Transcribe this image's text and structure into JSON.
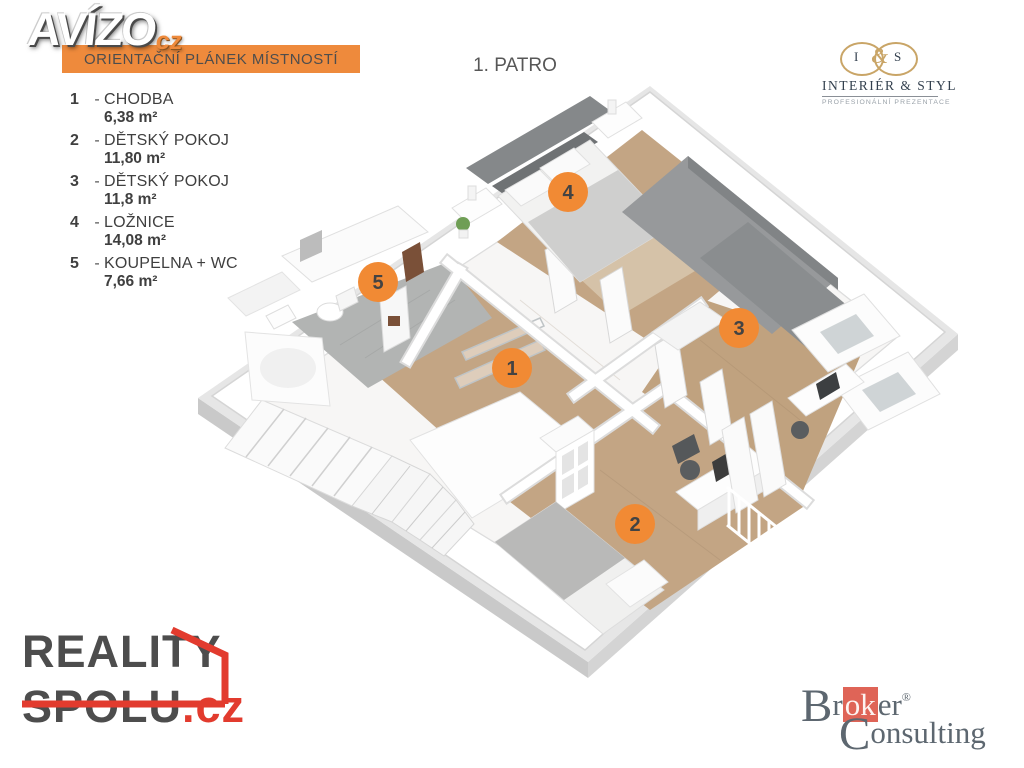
{
  "header": {
    "avizo_logo": {
      "text": "AVÍZO",
      "suffix": "cz"
    },
    "banner": {
      "text": "ORIENTAČNÍ PLÁNEK MÍSTNOSTÍ",
      "bg": "#EE8A3C"
    },
    "floor_title": "1. PATRO",
    "interier_styl_logo": {
      "monogram_left": "I",
      "monogram_amp": "&",
      "monogram_right": "S",
      "name": "INTERIÉR & STYL",
      "tagline": "PROFESIONÁLNÍ PREZENTACE"
    }
  },
  "legend": {
    "dash": "-",
    "items": [
      {
        "number": "1",
        "name": "CHODBA",
        "area": "6,38 m²"
      },
      {
        "number": "2",
        "name": "DĚTSKÝ POKOJ",
        "area": "11,80 m²"
      },
      {
        "number": "3",
        "name": "DĚTSKÝ POKOJ",
        "area": "11,8 m²"
      },
      {
        "number": "4",
        "name": "LOŽNICE",
        "area": "14,08 m²"
      },
      {
        "number": "5",
        "name": "KOUPELNA + WC",
        "area": "7,66 m²"
      }
    ]
  },
  "floor_plan": {
    "marker_color": "#F18A34",
    "markers": [
      {
        "number": "1",
        "room": "CHODBA",
        "x": 512,
        "y": 368
      },
      {
        "number": "2",
        "room": "DĚTSKÝ POKOJ",
        "x": 635,
        "y": 524
      },
      {
        "number": "3",
        "room": "DĚTSKÝ POKOJ",
        "x": 739,
        "y": 328
      },
      {
        "number": "4",
        "room": "LOŽNICE",
        "x": 568,
        "y": 192
      },
      {
        "number": "5",
        "room": "KOUPELNA + WC",
        "x": 378,
        "y": 282
      }
    ]
  },
  "footer": {
    "reality_spolu_logo": {
      "line1": "REALITY",
      "line2": "SPOLU",
      "suffix": ".cz"
    },
    "broker_logo": {
      "b": "B",
      "r1": "r",
      "hl": "ok",
      "r2": "er",
      "reg": "®",
      "c": "C",
      "rest": "onsulting"
    }
  },
  "colors": {
    "accent_orange": "#EE8A3C",
    "marker_orange": "#F18A34",
    "wood_floor": "#C3A584",
    "tile_floor": "#B2B4B3",
    "reality_red": "#E23B2E",
    "broker_red": "#DF6457",
    "broker_gray": "#5D6770",
    "gold": "#C9A567"
  }
}
